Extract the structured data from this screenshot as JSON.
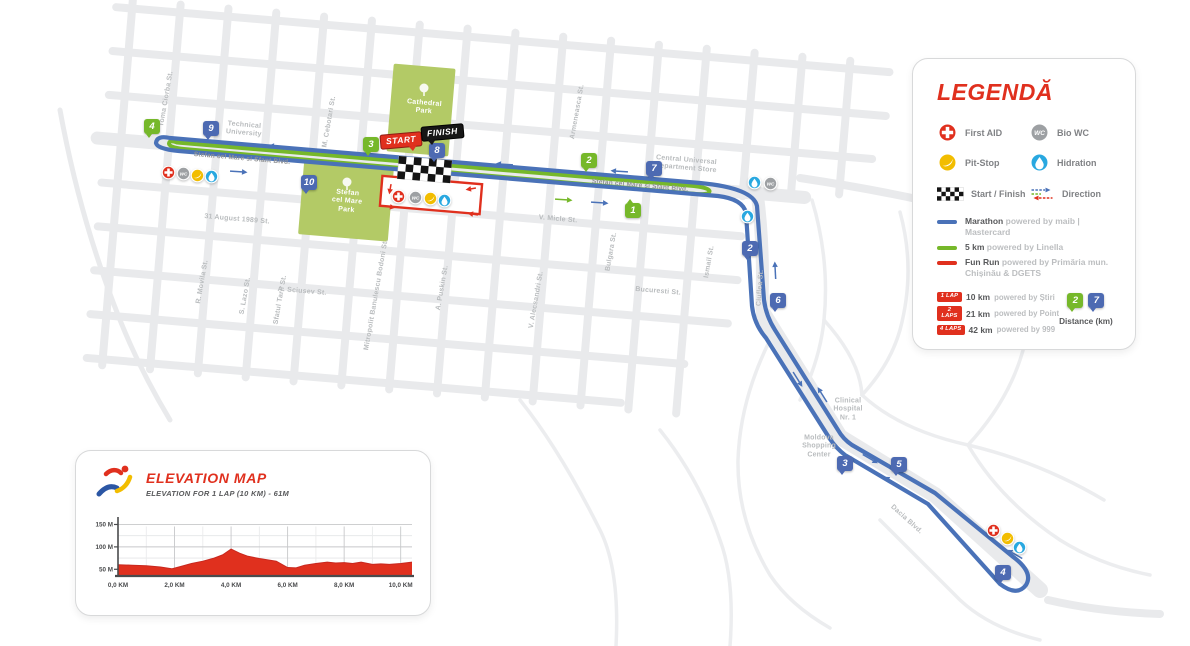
{
  "colors": {
    "marathon": "#4a72b8",
    "marathon_pin": "#4d6ab2",
    "five_km": "#76b82a",
    "fun_run": "#e0301e",
    "accent_red": "#e0301e",
    "park": "#b3ca66",
    "street": "#e9eaec",
    "first_aid": "#e0301e",
    "pit_stop": "#f2bd00",
    "hidration": "#29a8e0",
    "bio_wc": "#9da0a3",
    "text_gray": "#808285",
    "text_light": "#bcbec0",
    "text_dark": "#58595b",
    "map_label": "#b9bcbe"
  },
  "map": {
    "start_label": "START",
    "finish_label": "FINISH",
    "labels": [
      {
        "t": "Toma Ciorba St.",
        "x": 167,
        "y": 99,
        "r": -80
      },
      {
        "t": "M. Cebotari St.",
        "x": 330,
        "y": 122,
        "r": -80
      },
      {
        "t": "Armeneasca St.",
        "x": 578,
        "y": 112,
        "r": -80
      },
      {
        "t": "Bulgara St.",
        "x": 612,
        "y": 252,
        "r": -80
      },
      {
        "t": "Ismail St.",
        "x": 710,
        "y": 262,
        "r": -80
      },
      {
        "t": "Ciuflea St.",
        "x": 761,
        "y": 288,
        "r": -86
      },
      {
        "t": "R. Movila St.",
        "x": 203,
        "y": 282,
        "r": -80
      },
      {
        "t": "S. Lazo St.",
        "x": 246,
        "y": 296,
        "r": -80
      },
      {
        "t": "Sfatul Tarii St.",
        "x": 281,
        "y": 300,
        "r": -80
      },
      {
        "t": "Mitropolit Banulescu Bodoni St.",
        "x": 377,
        "y": 295,
        "r": -80
      },
      {
        "t": "A. Puskin St.",
        "x": 443,
        "y": 288,
        "r": -80
      },
      {
        "t": "V. Alecsandri St.",
        "x": 537,
        "y": 300,
        "r": -80
      },
      {
        "t": "31 August 1989 St.",
        "x": 237,
        "y": 220,
        "r": 4.8
      },
      {
        "t": "A. Sciusev St.",
        "x": 302,
        "y": 292,
        "r": 4.8
      },
      {
        "t": "V. Micle St.",
        "x": 558,
        "y": 220,
        "r": 4.8
      },
      {
        "t": "Bucuresti St.",
        "x": 658,
        "y": 292,
        "r": 4.8
      },
      {
        "t": "Dacia Blvd.",
        "x": 906,
        "y": 520,
        "r": 42
      },
      {
        "t": "Stefan cel Mare si Sfant Blvd.",
        "x": 242,
        "y": 159,
        "r": 4.8,
        "k": "route"
      },
      {
        "t": "Stefan cel Mare si Sfant Blvd.",
        "x": 640,
        "y": 186,
        "r": 4.8,
        "k": "route"
      },
      {
        "t": "Technical\nUniversity",
        "x": 244,
        "y": 130,
        "r": 4.8,
        "k": "place"
      },
      {
        "t": "Central Universal\nDepartment Store",
        "x": 686,
        "y": 165,
        "r": 4.8,
        "k": "place"
      },
      {
        "t": "Clinical\nHospital\nNr. 1",
        "x": 848,
        "y": 410,
        "r": 0,
        "k": "place"
      },
      {
        "t": "Moldova\nShopping\nCenter",
        "x": 819,
        "y": 447,
        "r": 0,
        "k": "place"
      },
      {
        "t": "Cathedral\nPark",
        "x": 424,
        "y": 108,
        "r": 4.8,
        "k": "park"
      },
      {
        "t": "Stefan\ncel Mare\nPark",
        "x": 347,
        "y": 202,
        "r": 4.8,
        "k": "park"
      }
    ],
    "pins": [
      {
        "c": "green",
        "n": "4",
        "x": 152,
        "y": 126
      },
      {
        "c": "blue",
        "n": "9",
        "x": 211,
        "y": 128
      },
      {
        "c": "blue",
        "n": "10",
        "x": 309,
        "y": 182
      },
      {
        "c": "green",
        "n": "3",
        "x": 371,
        "y": 144
      },
      {
        "c": "blue",
        "n": "8",
        "x": 437,
        "y": 150
      },
      {
        "c": "green",
        "n": "2",
        "x": 589,
        "y": 160
      },
      {
        "c": "blue",
        "n": "7",
        "x": 654,
        "y": 168
      },
      {
        "c": "green",
        "n": "1",
        "x": 633,
        "y": 210,
        "up": true
      },
      {
        "c": "blue",
        "n": "2",
        "x": 750,
        "y": 248
      },
      {
        "c": "blue",
        "n": "6",
        "x": 778,
        "y": 300
      },
      {
        "c": "blue",
        "n": "3",
        "x": 845,
        "y": 463
      },
      {
        "c": "blue",
        "n": "5",
        "x": 899,
        "y": 464
      },
      {
        "c": "blue",
        "n": "4",
        "x": 1003,
        "y": 572
      }
    ],
    "icons": [
      {
        "t": "first-aid",
        "x": 168,
        "y": 172
      },
      {
        "t": "bio-wc",
        "x": 183,
        "y": 173
      },
      {
        "t": "pit-stop",
        "x": 197,
        "y": 175
      },
      {
        "t": "hidration",
        "x": 211,
        "y": 176
      },
      {
        "t": "first-aid",
        "x": 398,
        "y": 196
      },
      {
        "t": "bio-wc",
        "x": 415,
        "y": 197
      },
      {
        "t": "pit-stop",
        "x": 430,
        "y": 198
      },
      {
        "t": "hidration",
        "x": 444,
        "y": 200
      },
      {
        "t": "hidration",
        "x": 754,
        "y": 182
      },
      {
        "t": "bio-wc",
        "x": 770,
        "y": 183
      },
      {
        "t": "hidration",
        "x": 747,
        "y": 216
      },
      {
        "t": "first-aid",
        "x": 993,
        "y": 530
      },
      {
        "t": "pit-stop",
        "x": 1007,
        "y": 538
      },
      {
        "t": "hidration",
        "x": 1019,
        "y": 547
      }
    ],
    "arrows": [
      {
        "x": 273,
        "y": 146,
        "r": 184
      },
      {
        "x": 500,
        "y": 164,
        "r": 184
      },
      {
        "x": 615,
        "y": 171,
        "r": 184
      },
      {
        "x": 243,
        "y": 172,
        "r": 4
      },
      {
        "x": 568,
        "y": 200,
        "r": 4,
        "c": "green"
      },
      {
        "x": 604,
        "y": 203,
        "r": 4
      },
      {
        "x": 775,
        "y": 266,
        "r": -93
      },
      {
        "x": 800,
        "y": 383,
        "r": 58
      },
      {
        "x": 820,
        "y": 391,
        "r": -122
      },
      {
        "x": 874,
        "y": 461,
        "r": 30
      },
      {
        "x": 888,
        "y": 479,
        "r": -150
      },
      {
        "x": 1011,
        "y": 552,
        "r": -150
      },
      {
        "x": 390,
        "y": 190,
        "r": 100,
        "c": "red",
        "l": 6
      },
      {
        "x": 470,
        "y": 189,
        "r": 170,
        "c": "red",
        "l": 6
      },
      {
        "x": 391,
        "y": 207,
        "r": 10,
        "c": "red",
        "l": 6
      },
      {
        "x": 472,
        "y": 214,
        "r": 190,
        "c": "red",
        "l": 6
      }
    ]
  },
  "legend": {
    "title": "LEGENDĂ",
    "items": [
      {
        "icon": "first-aid",
        "label": "First AID"
      },
      {
        "icon": "bio-wc",
        "label": "Bio WC"
      },
      {
        "icon": "pit-stop",
        "label": "Pit-Stop"
      },
      {
        "icon": "hidration",
        "label": "Hidration"
      },
      {
        "icon": "start-finish",
        "label": "Start / Finish"
      },
      {
        "icon": "direction",
        "label": "Direction"
      }
    ],
    "routes": [
      {
        "name": "Marathon",
        "rest": "powered by maib | Mastercard"
      },
      {
        "name": "5 km",
        "rest": "powered by Linella"
      },
      {
        "name": "Fun Run",
        "rest": "powered by Primăria mun. Chișinău & DGETS"
      }
    ],
    "laps": [
      {
        "badge": "1 LAP",
        "name": "10 km",
        "rest": "powered by Știri"
      },
      {
        "badge": "2 LAPS",
        "name": "21 km",
        "rest": "powered by Point"
      },
      {
        "badge": "4 LAPS",
        "name": "42 km",
        "rest": "powered by 999"
      }
    ],
    "distance_pins": {
      "green": "2",
      "blue": "7"
    },
    "distance_label": "Distance (km)"
  },
  "elevation": {
    "title": "ELEVATION MAP",
    "subtitle": "ELEVATION FOR 1 LAP (10 KM) - 61M"
  },
  "chart_data": {
    "type": "area",
    "title": "ELEVATION MAP",
    "subtitle": "ELEVATION FOR 1 LAP (10 KM) - 61M",
    "xlabel": "distance (km)",
    "ylabel": "elevation (m)",
    "xlim": [
      0,
      10.4
    ],
    "ylim": [
      35,
      160
    ],
    "x_ticks": [
      "0,0 KM",
      "2,0 KM",
      "4,0 KM",
      "6,0 KM",
      "8,0 KM",
      "10,0 KM"
    ],
    "x_tick_km": [
      0,
      2,
      4,
      6,
      8,
      10
    ],
    "y_ticks": [
      "50 M",
      "100 M",
      "150 M"
    ],
    "y_tick_m": [
      50,
      100,
      150
    ],
    "grid": true,
    "legend_position": "none",
    "series": [
      {
        "name": "Elevation (1 lap)",
        "color": "#e0301e",
        "points": [
          [
            0,
            60
          ],
          [
            0.5,
            59
          ],
          [
            1,
            58
          ],
          [
            1.5,
            55
          ],
          [
            1.9,
            51
          ],
          [
            2.2,
            56
          ],
          [
            2.6,
            63
          ],
          [
            3,
            68
          ],
          [
            3.4,
            75
          ],
          [
            3.7,
            82
          ],
          [
            4,
            95
          ],
          [
            4.3,
            86
          ],
          [
            4.6,
            79
          ],
          [
            5,
            74
          ],
          [
            5.3,
            71
          ],
          [
            5.6,
            68
          ],
          [
            6,
            54
          ],
          [
            6.3,
            53
          ],
          [
            6.6,
            59
          ],
          [
            7,
            63
          ],
          [
            7.4,
            66
          ],
          [
            7.7,
            64
          ],
          [
            8,
            65
          ],
          [
            8.3,
            63
          ],
          [
            8.6,
            66
          ],
          [
            9,
            61
          ],
          [
            9.3,
            62
          ],
          [
            9.6,
            61
          ],
          [
            10,
            63
          ],
          [
            10.4,
            66
          ]
        ]
      }
    ]
  }
}
